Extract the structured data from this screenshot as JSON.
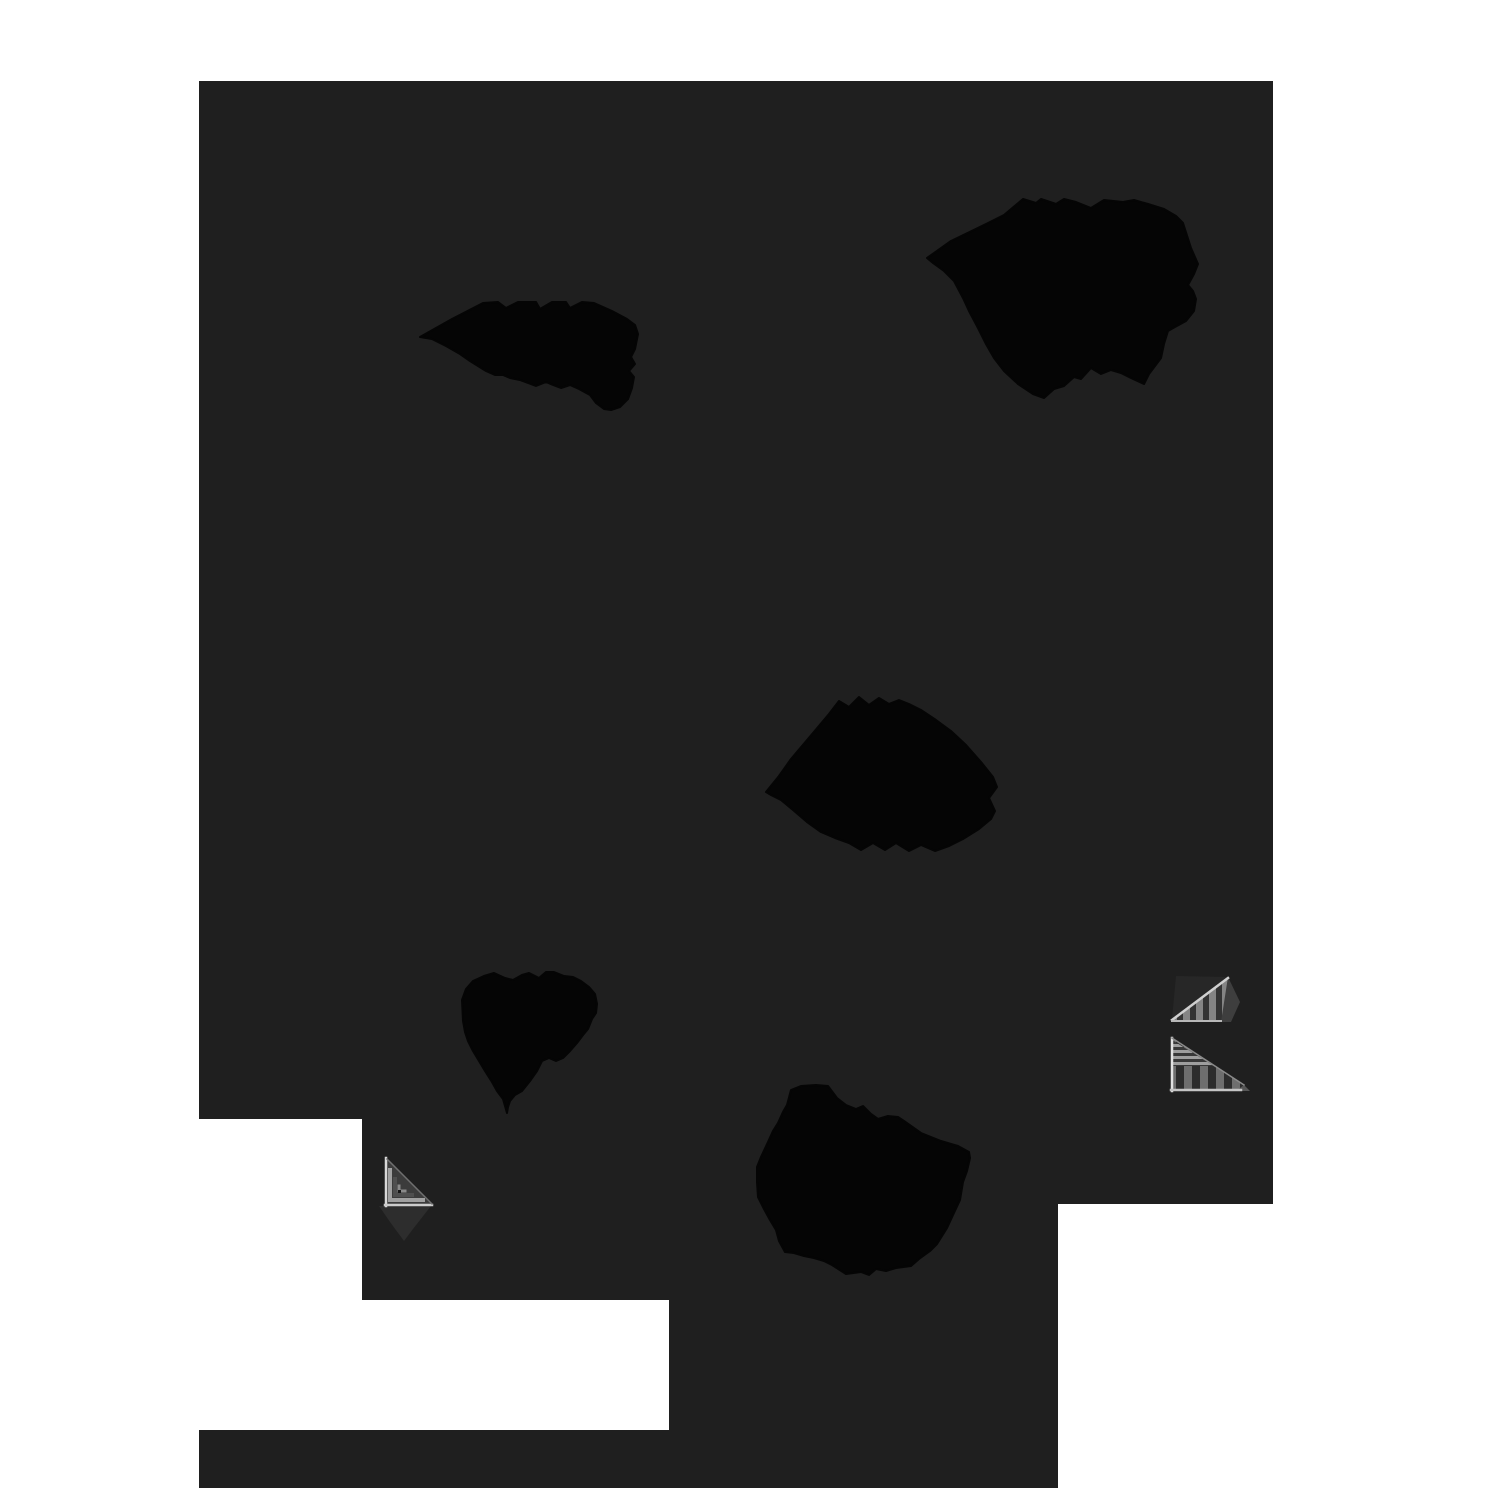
{
  "meta": {
    "description": "Abstract monochrome graphic: large dark charcoal surface with stepped white cutouts along the left, bottom and lower-right edges, five organic pure-black ink blots, and three small gray striped staircase motifs",
    "canvas": {
      "width": 1500,
      "height": 1500
    }
  },
  "palette": {
    "background": "#ffffff",
    "surface": "#1f1f1f",
    "blob": "#050505",
    "shadow": "#2d2d2d",
    "edge_highlight": "#d8d8d8",
    "edge_soft": "#c4c4c4",
    "stripe_light": "#848484",
    "stripe_dark": "#333333"
  },
  "patterns": [
    {
      "id": "patv",
      "w": 13,
      "h": 80,
      "bars": [
        {
          "x": 0,
          "y": 0,
          "w": 7,
          "h": 80,
          "f": "#848484"
        },
        {
          "x": 7,
          "y": 0,
          "w": 6,
          "h": 80,
          "f": "#333333"
        }
      ]
    },
    {
      "id": "patv2",
      "w": 16,
      "h": 80,
      "bars": [
        {
          "x": 0,
          "y": 0,
          "w": 8,
          "h": 80,
          "f": "#6e6e6e"
        },
        {
          "x": 8,
          "y": 0,
          "w": 8,
          "h": 80,
          "f": "#2c2c2c"
        }
      ]
    },
    {
      "id": "path1",
      "w": 80,
      "h": 6,
      "bars": [
        {
          "x": 0,
          "y": 0,
          "w": 80,
          "h": 3,
          "f": "#9e9e9e"
        },
        {
          "x": 0,
          "y": 3,
          "w": 80,
          "h": 3,
          "f": "#383838"
        }
      ]
    }
  ],
  "shapes": {
    "surface": {
      "name": "dark-surface",
      "points": "199,81 1273,81 1273,1204 1058,1204 1058,1488 199,1488 199,1430 669,1430 669,1300 362,1300 362,1119 199,1119"
    },
    "blobs": [
      {
        "name": "ink-blob-top-left",
        "points": "420,337 452,319 483,303 498,302 506,308 518,302 536,302 540,309 552,302 566,302 570,308 582,302 594,303 612,311 627,319 635,325 638,334 635,349 631,357 635,364 629,371 634,377 632,388 628,399 620,407 611,410 604,409 596,403 590,395 579,389 570,385 561,388 553,385 546,382 536,386 528,383 520,380 510,378 503,375 495,375 486,371 478,366 470,361 460,354 446,346 432,339"
      },
      {
        "name": "ink-blob-top-right",
        "points": "927,258 951,241 986,224 1004,215 1023,199 1036,203 1041,199 1056,204 1064,199 1076,202 1091,208 1104,200 1123,202 1134,200 1148,204 1164,209 1176,216 1183,223 1191,248 1198,264 1194,274 1188,285 1193,291 1196,299 1194,311 1186,321 1175,327 1168,331 1164,344 1161,358 1149,374 1144,384 1131,378 1121,373 1111,370 1101,374 1091,368 1081,379 1074,377 1064,386 1054,389 1044,398 1033,394 1018,384 1004,371 994,358 986,344 978,328 969,311 963,298 954,281 944,271 933,263"
      },
      {
        "name": "ink-blob-center",
        "points": "766,792 779,776 791,759 813,733 829,714 839,701 849,707 859,697 869,705 879,698 889,704 899,700 909,704 921,710 936,720 951,731 966,745 981,762 993,777 997,787 989,798 995,811 991,819 979,829 963,839 949,846 935,851 921,845 909,851 896,843 885,850 873,843 861,850 849,843 835,838 821,832 807,822 793,810 781,800 771,795"
      },
      {
        "name": "ink-blob-left-middle",
        "points": "462,1000 466,989 473,981 484,976 494,973 505,978 513,980 522,975 529,973 539,978 546,972 554,972 564,976 573,977 581,981 589,987 595,994 597,1004 596,1013 592,1019 588,1029 583,1035 577,1043 570,1051 563,1058 556,1061 549,1058 542,1061 537,1071 530,1081 522,1091 515,1095 510,1101 508,1107 507,1113 503,1099 497,1091 492,1082 485,1071 479,1061 473,1051 468,1041 465,1032 463,1021"
      },
      {
        "name": "ink-blob-bottom-center",
        "points": "787,1105 791,1090 801,1086 816,1085 828,1086 837,1098 846,1105 856,1109 863,1106 871,1114 878,1119 888,1116 898,1117 904,1121 921,1133 941,1141 958,1146 969,1152 970,1158 967,1171 963,1182 960,1200 953,1215 947,1228 937,1244 930,1251 919,1259 911,1266 896,1268 886,1271 876,1269 869,1275 861,1272 846,1274 832,1265 824,1261 814,1258 804,1256 794,1253 785,1252 779,1241 776,1230 770,1220 764,1209 758,1197 757,1182 757,1167 761,1157 768,1142 773,1131 778,1123 783,1112"
      }
    ],
    "stairs": [
      {
        "name": "staircase-motif-bottom-left",
        "elements": [
          {
            "t": "poly",
            "n": "cast-shadow",
            "p": "379,1206 431,1206 413,1229 404,1241 390,1222",
            "f": "#2d2d2d"
          },
          {
            "t": "poly",
            "n": "stair-face",
            "p": "386,1158 432,1205 386,1205",
            "f": "#3c3c3c"
          },
          {
            "t": "pline",
            "n": "stair-step-band",
            "p": "390,1170 390,1200 423,1200",
            "s": "#a0a0a0",
            "w": 4
          },
          {
            "t": "pline",
            "n": "stair-step-band",
            "p": "395,1179 395,1195 412,1195",
            "s": "#4f4f4f",
            "w": 4
          },
          {
            "t": "pline",
            "n": "stair-step-band",
            "p": "399,1186 399,1191 405,1191",
            "s": "#8a8a8a",
            "w": 3
          },
          {
            "t": "poly",
            "n": "stair-core-dot",
            "p": "398,1190 401,1190 401,1193 398,1193",
            "f": "#161616"
          },
          {
            "t": "pline",
            "n": "edge-highlight",
            "p": "386,1158 386,1206",
            "s": "#d8d8d8",
            "w": 2.5
          },
          {
            "t": "pline",
            "n": "edge-highlight",
            "p": "385,1205 432,1205",
            "s": "#cccccc",
            "w": 2.5
          },
          {
            "t": "pline",
            "n": "edge-hypotenuse",
            "p": "387,1159 432,1204",
            "s": "#6f6f6f",
            "w": 1.5
          }
        ]
      },
      {
        "name": "staircase-motif-right-upper",
        "elements": [
          {
            "t": "poly",
            "n": "stair-back-face",
            "p": "1176,976 1228,977 1172,1019",
            "f": "#272727"
          },
          {
            "t": "poly",
            "n": "stair-face",
            "p": "1172,1021 1228,978 1222,1022 1172,1022",
            "f": "url(#patv)"
          },
          {
            "t": "poly",
            "n": "stair-side-flap",
            "p": "1228,977 1240,1002 1231,1022 1221,1022",
            "f": "#3e3e3e"
          },
          {
            "t": "pline",
            "n": "edge-hypotenuse",
            "p": "1172,1020 1228,978",
            "s": "#d0d0d0",
            "w": 2.5
          },
          {
            "t": "pline",
            "n": "edge-highlight",
            "p": "1172,1021 1221,1021",
            "s": "#b8b8b8",
            "w": 2
          }
        ]
      },
      {
        "name": "staircase-motif-right-lower",
        "elements": [
          {
            "t": "poly",
            "n": "stair-face",
            "p": "1172,1038 1244,1085 1238,1091 1172,1091",
            "f": "url(#patv2)"
          },
          {
            "t": "poly",
            "n": "stair-top-steps",
            "p": "1172,1040 1214,1066 1172,1066",
            "f": "url(#path1)"
          },
          {
            "t": "poly",
            "n": "stair-tip",
            "p": "1244,1085 1250,1091 1236,1091",
            "f": "#565656"
          },
          {
            "t": "pline",
            "n": "edge-highlight",
            "p": "1172,1038 1172,1091",
            "s": "#e2e2e2",
            "w": 2.5
          },
          {
            "t": "pline",
            "n": "edge-highlight",
            "p": "1171,1090 1241,1090",
            "s": "#c4c4c4",
            "w": 2.5
          },
          {
            "t": "pline",
            "n": "edge-hypotenuse",
            "p": "1172,1038 1244,1085",
            "s": "#8a8a8a",
            "w": 1.5
          }
        ]
      }
    ]
  }
}
